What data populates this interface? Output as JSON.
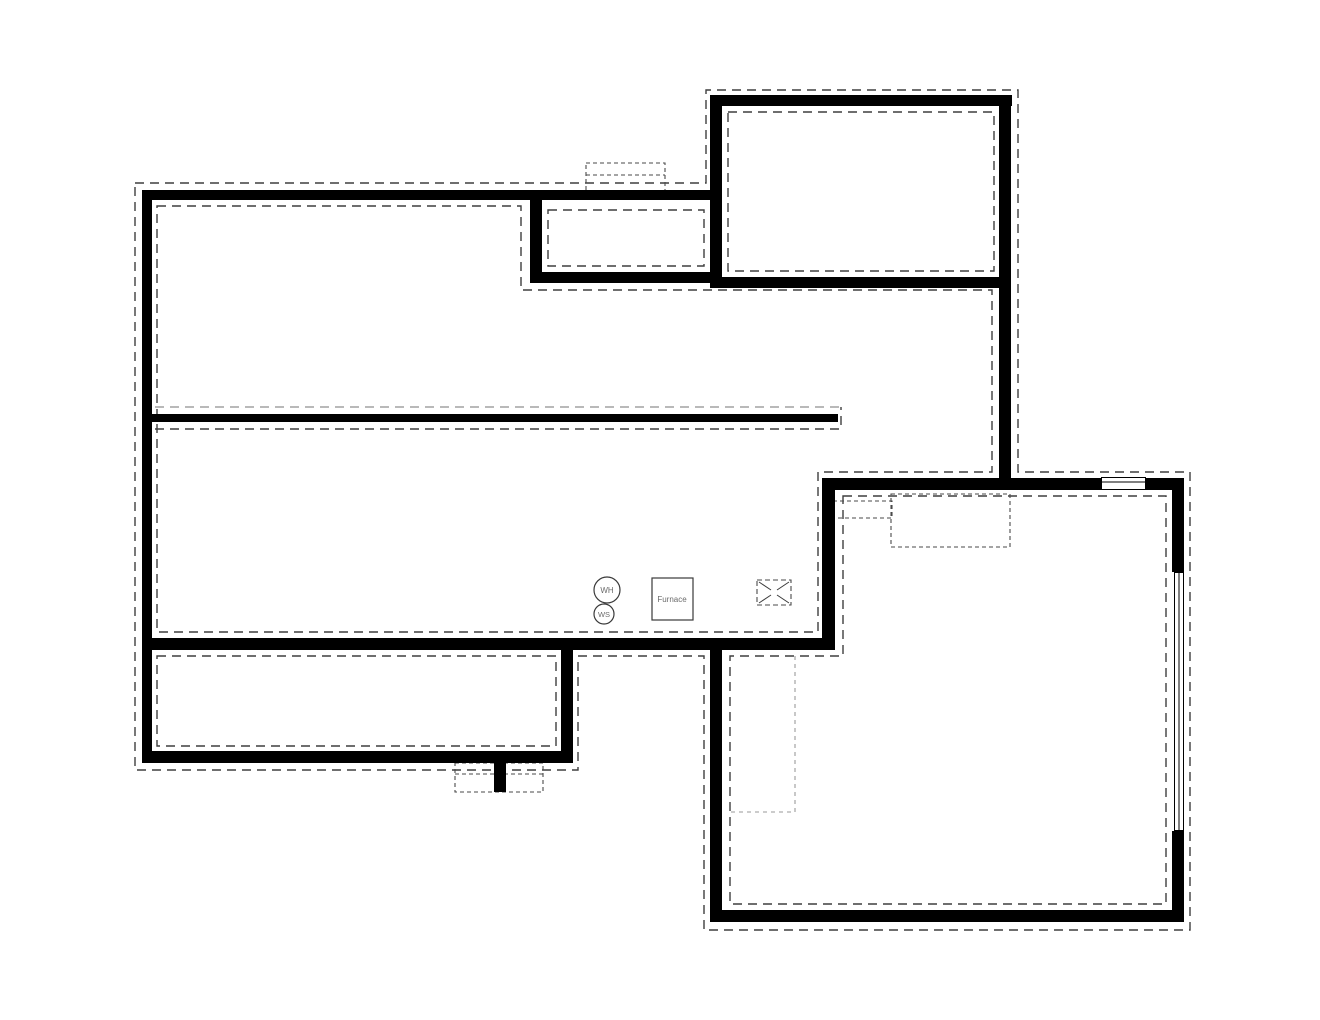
{
  "plan": {
    "labels": {
      "water_heater": "WH",
      "water_softener": "WS",
      "furnace": "Furnace"
    },
    "symbols": {
      "crossed_box": "concrete-pad-symbol",
      "top_wall_window": "window-symbol",
      "right_wall_window": "window-symbol",
      "chimney_bump": "chimney-footing-symbol",
      "porch_post": "porch-post-footing-symbol",
      "stairs_area": "stair-outline-symbol"
    },
    "colors": {
      "background": "#ffffff",
      "wall": "#000000",
      "footing_dash": "#3f3f3f",
      "fine_dash": "#4a4a4a",
      "light_dash": "#9a9a9a",
      "label_text": "#6b6b6b"
    }
  }
}
